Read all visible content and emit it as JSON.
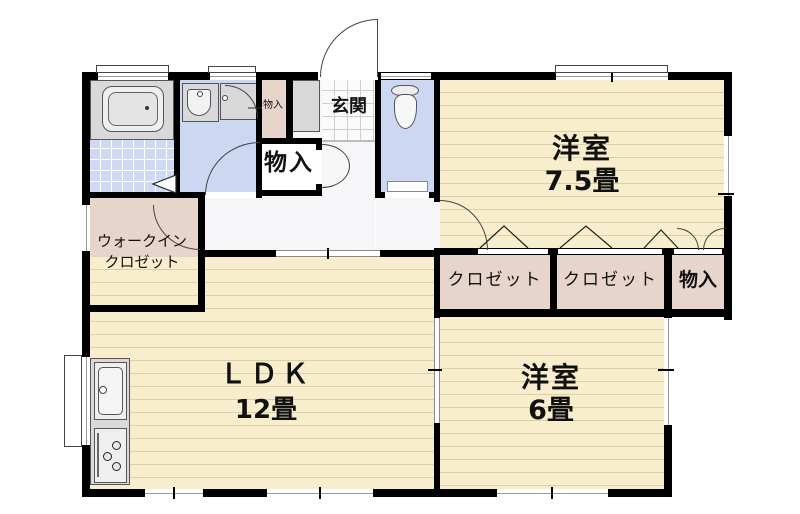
{
  "plan_title": "floor-plan",
  "colors": {
    "wall": "#000000",
    "room_fill": "#f8eecd",
    "closet_fill": "#e7d5cb",
    "wet_fill": "#ccd7f1",
    "hall_fill": "#f6f6f8",
    "fixture_fill": "#d9d9d9"
  },
  "rooms": {
    "entrance": {
      "label": "玄関"
    },
    "storage_small": {
      "label": "物入"
    },
    "storage_hall": {
      "label": "物入"
    },
    "western_75": {
      "label": "洋室",
      "size": "7.5畳"
    },
    "wic": {
      "line1": "ウォークイン",
      "line2": "クロゼット"
    },
    "closet_a": {
      "label": "クロゼット"
    },
    "closet_b": {
      "label": "クロゼット"
    },
    "storage_east": {
      "label": "物入"
    },
    "ldk": {
      "label": "ＬＤＫ",
      "size": "12畳"
    },
    "western_6": {
      "label": "洋室",
      "size": "6畳"
    }
  }
}
